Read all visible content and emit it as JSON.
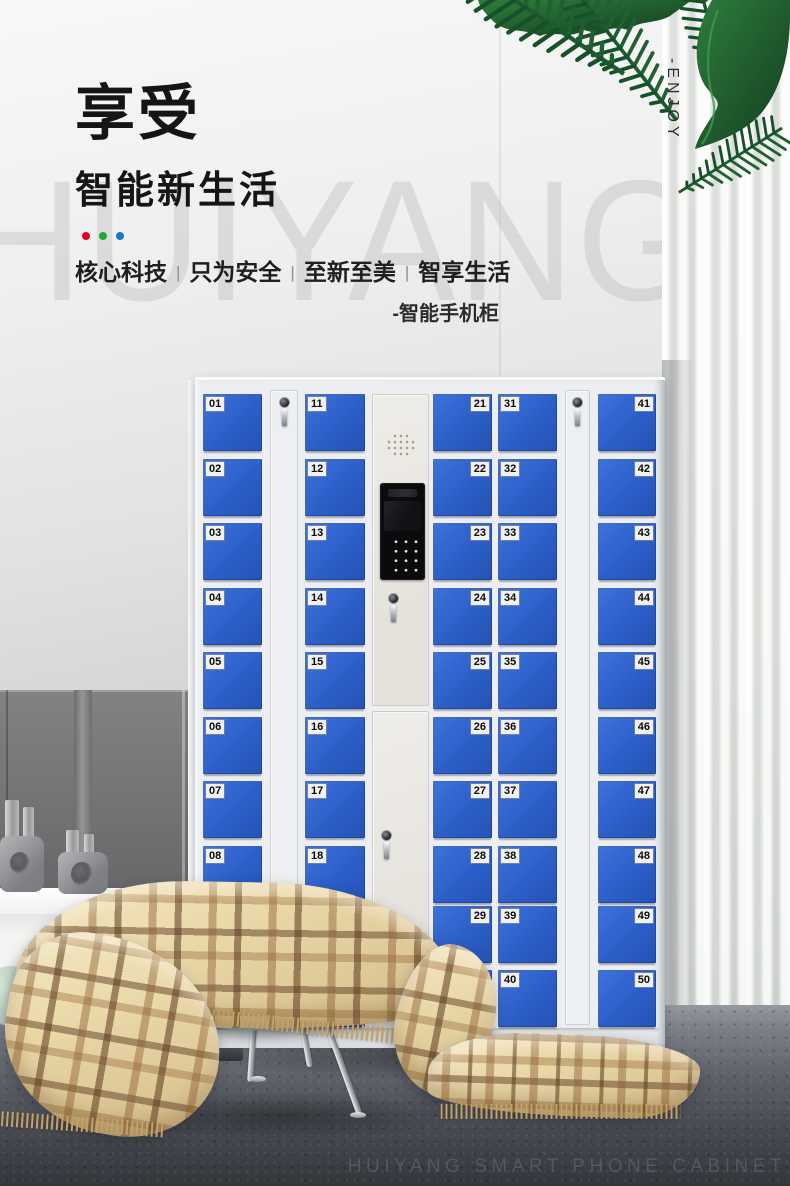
{
  "brand": {
    "watermark": "HUIYANG",
    "vertical_slogan": "-ENJOY",
    "footer": "HUIYANG SMART PHONE CABINET"
  },
  "hero": {
    "title": "享受",
    "subtitle": "智能新生活",
    "separator": "|",
    "tagline": [
      "核心科技",
      "只为安全",
      "至新至美",
      "智享生活"
    ],
    "note": "-智能手机柜",
    "dot_colors": [
      "#e6001f",
      "#21a837",
      "#1878c8"
    ]
  },
  "cabinet": {
    "locker_blue": "#2e5fc9",
    "columns": [
      {
        "id": "col-1",
        "type": "lockers",
        "label_side": "left",
        "numbers": [
          "01",
          "02",
          "03",
          "04",
          "05",
          "06",
          "07",
          "08",
          "09",
          "10"
        ]
      },
      {
        "id": "col-2",
        "type": "lock",
        "icon": "keyhole-with-key"
      },
      {
        "id": "col-3",
        "type": "lockers",
        "label_side": "left",
        "numbers": [
          "11",
          "12",
          "13",
          "14",
          "15",
          "16",
          "17",
          "18",
          "19",
          "20"
        ]
      },
      {
        "id": "col-4",
        "type": "control",
        "icons": [
          "speaker-grille",
          "camera",
          "screen",
          "keypad",
          "keyhole-with-key"
        ]
      },
      {
        "id": "col-5",
        "type": "lockers",
        "label_side": "right",
        "numbers": [
          "21",
          "22",
          "23",
          "24",
          "25",
          "26",
          "27",
          "28",
          "29",
          "30"
        ]
      },
      {
        "id": "col-6",
        "type": "lockers",
        "label_side": "left",
        "numbers": [
          "31",
          "32",
          "33",
          "34",
          "35",
          "36",
          "37",
          "38",
          "39",
          "40"
        ]
      },
      {
        "id": "col-7",
        "type": "lock",
        "icon": "keyhole-with-key"
      },
      {
        "id": "col-8",
        "type": "lockers",
        "label_side": "right",
        "numbers": [
          "41",
          "42",
          "43",
          "44",
          "45",
          "46",
          "47",
          "48",
          "49",
          "50"
        ]
      }
    ]
  },
  "scene": {
    "objects": [
      "palm-leaves",
      "sheer-curtain",
      "plaid-blanket",
      "mint-stool",
      "decor-vases",
      "white-console",
      "dark-wall-panels",
      "speckled-floor"
    ]
  }
}
